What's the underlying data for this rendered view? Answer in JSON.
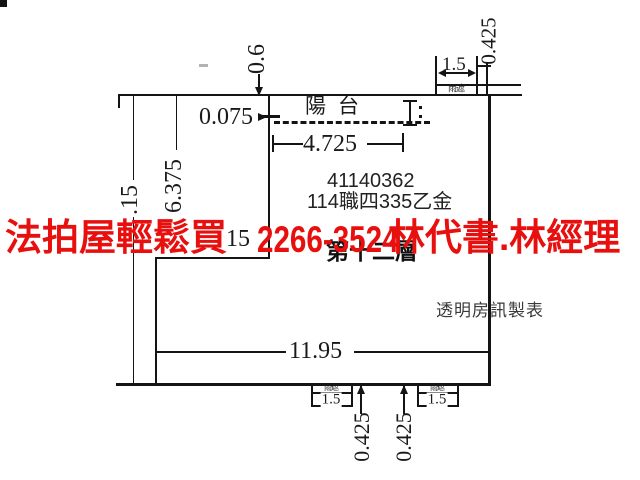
{
  "labels": {
    "balcony": "陽台",
    "floor": "第十二層",
    "canopy": "雨遮",
    "watermark": "透明房訊製表",
    "case_number": "41140362",
    "case_reference": "114職四335乙金"
  },
  "dims": {
    "top_offset": "0.6",
    "canopy_top_width": "1.5",
    "canopy_top_depth": "0.425",
    "wall_inset": "0.075",
    "balcony_width": "4.725",
    "left_total_partial": ".15",
    "left_upper": "6.375",
    "mid_partial": "15",
    "bottom_width": "11.95",
    "canopy_bottom_left_width": "1.5",
    "canopy_bottom_left_depth": "0.425",
    "canopy_bottom_right_width": "1.5",
    "canopy_bottom_right_depth": "0.425"
  },
  "overlay": {
    "full_text": "法拍屋輕鬆買_2266-3524_林代書.林經理",
    "segments": [
      "法拍屋輕鬆買",
      "2266-3524",
      "林代書.林經理"
    ],
    "color": "#e8100e"
  },
  "colors": {
    "line": "#141414",
    "background": "#ffffff",
    "dimension_text": "#1a1a1a",
    "watermark_text": "#3a3a3a"
  }
}
